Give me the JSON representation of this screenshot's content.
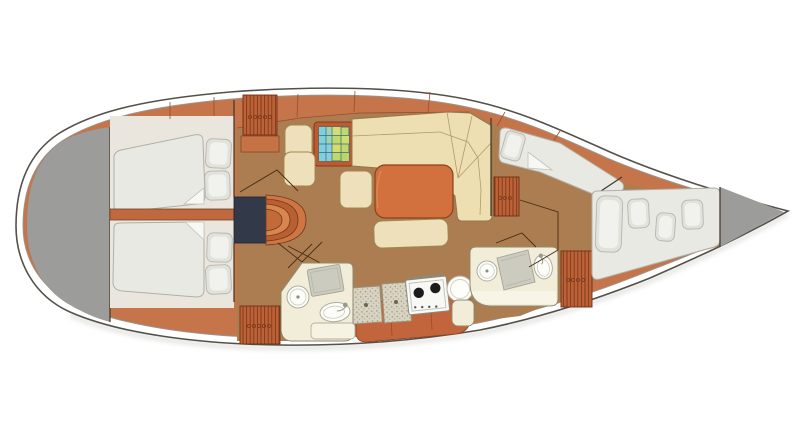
{
  "diagram": {
    "title": "Sailboat interior layout plan — top view",
    "type": "boat-floor-plan",
    "orientation": {
      "bow": "right",
      "stern": "left"
    },
    "areas": [
      {
        "name": "stern-deck",
        "description": "grey deck area at rounded stern"
      },
      {
        "name": "aft-cabin-port",
        "fixtures": [
          "double-berth",
          "pillow",
          "pillow"
        ]
      },
      {
        "name": "aft-cabin-starboard",
        "fixtures": [
          "double-berth",
          "pillow",
          "pillow"
        ]
      },
      {
        "name": "companionway",
        "fixtures": [
          "steps",
          "engine-box"
        ]
      },
      {
        "name": "saloon",
        "fixtures": [
          "l-shaped-settee",
          "dining-table",
          "bench-seat",
          "stool",
          "chart-table",
          "nav-seat",
          "storage-locker"
        ]
      },
      {
        "name": "galley",
        "fixtures": [
          "worktop",
          "two-burner-stove",
          "round-sink",
          "cabinet"
        ]
      },
      {
        "name": "aft-head",
        "fixtures": [
          "toilet",
          "shower-seat",
          "washbasin",
          "vanity-cabinet"
        ]
      },
      {
        "name": "forward-head",
        "fixtures": [
          "toilet",
          "shower-seat",
          "washbasin",
          "locker"
        ]
      },
      {
        "name": "forward-cabin",
        "fixtures": [
          "berth-settee",
          "double-berth",
          "pillow",
          "pillow",
          "pillow",
          "pillow",
          "locker"
        ]
      },
      {
        "name": "bow-deck",
        "description": "grey deck triangle at pointed bow"
      }
    ]
  },
  "colors": {
    "hull_outline": "#55504a",
    "inner_line": "#9a958d",
    "deck_gray": "#9c9c9a",
    "rim_orange": "#c6744a",
    "cabinet_orange": "#c2653c",
    "floor_brown": "#ab7d50",
    "cabin_white": "#eae6dd",
    "mattress": "#e9e9e4",
    "pillow": "#e2e2dd",
    "cream": "#eee0ba",
    "settee_cream": "#eedfb2",
    "table_orange": "#d2713e",
    "navy": "#323949",
    "head_floor": "#f2edd9",
    "fixture_white": "#fdfdf9",
    "shower_gray": "#cbcbc0",
    "chart_cyan": "#7ed0dc",
    "chart_green": "#c2d86e",
    "bulkhead": "#4a3a2c"
  }
}
